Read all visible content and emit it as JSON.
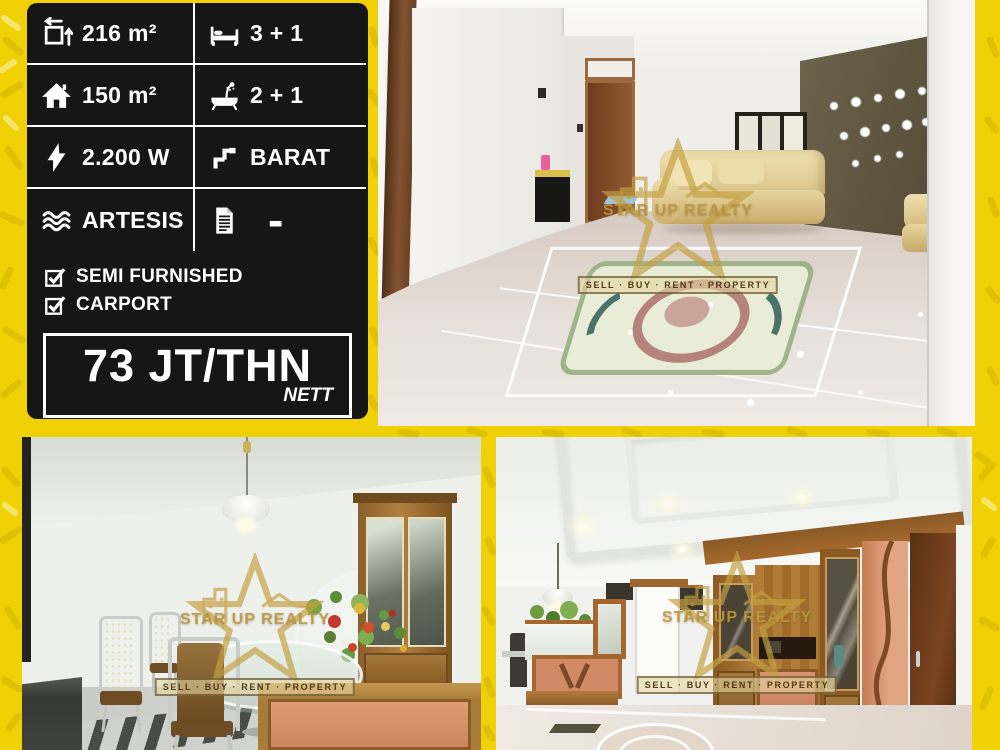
{
  "panel": {
    "specs": [
      {
        "icon": "area-icon",
        "value": "216 m²"
      },
      {
        "icon": "bed-icon",
        "value": "3 + 1"
      },
      {
        "icon": "house-icon",
        "value": "150 m²"
      },
      {
        "icon": "bath-icon",
        "value": "2 + 1"
      },
      {
        "icon": "power-icon",
        "value": "2.200 W"
      },
      {
        "icon": "direction-icon",
        "value": "BARAT"
      },
      {
        "icon": "water-icon",
        "value": "ARTESIS"
      },
      {
        "icon": "document-icon",
        "value": "-"
      }
    ],
    "features": [
      {
        "label": "SEMI FURNISHED"
      },
      {
        "label": "CARPORT"
      }
    ],
    "price": {
      "amount": "73 JT/THN",
      "note": "NETT"
    }
  },
  "watermark": {
    "title": "STAR UP REALTY",
    "tagline": "SELL · BUY · RENT · PROPERTY"
  },
  "colors": {
    "background": "#F0D105",
    "panel": "#161616",
    "text": "#FFFFFF"
  }
}
